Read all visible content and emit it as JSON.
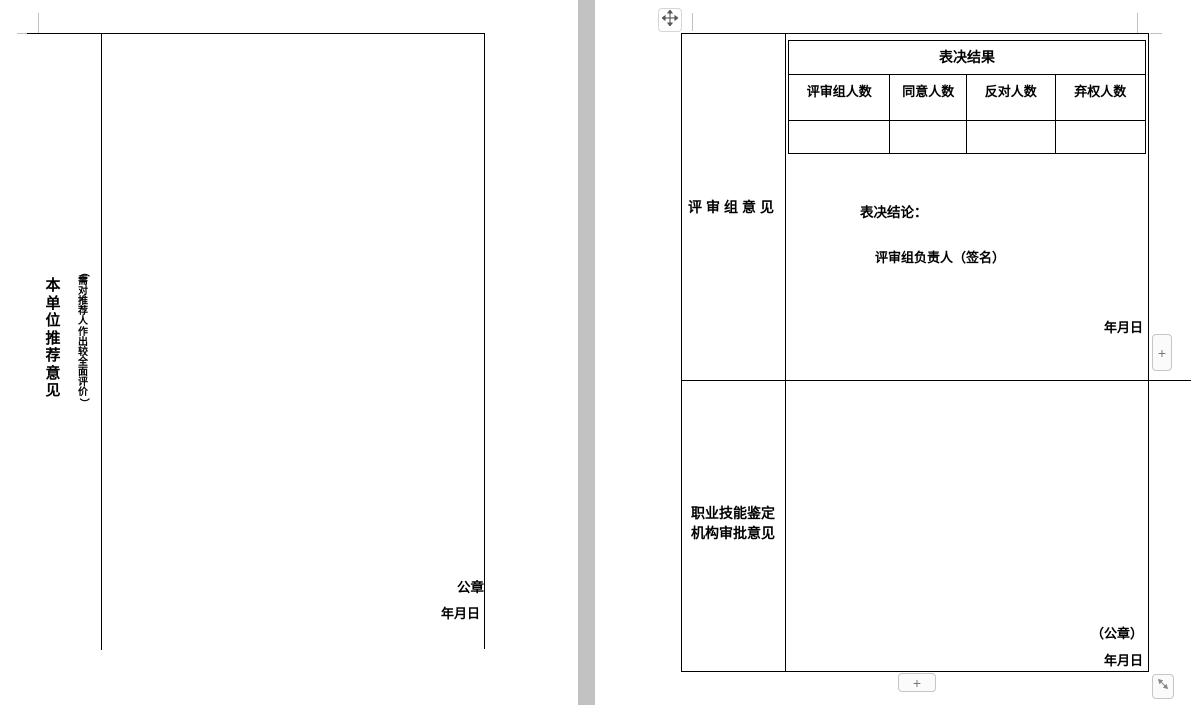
{
  "colors": {
    "page_bg": "#ffffff",
    "table_border": "#000000",
    "page_divider": "#c2c2c2",
    "margin_mark": "#c0c0c0",
    "control_border": "#c6c6c6",
    "control_bg": "#fbfbfb",
    "control_fg": "#777777"
  },
  "page_left": {
    "row_label": "本单位推荐意见",
    "row_label_note": "（需对推荐人作出较全面评价）",
    "seal_label": "公章",
    "date_label": "年月日"
  },
  "page_right": {
    "review_section": {
      "row_label": "评审组意见",
      "vote_table": {
        "title": "表决结果",
        "columns": [
          "评审组人数",
          "同意人数",
          "反对人数",
          "弃权人数"
        ],
        "values": [
          "",
          "",
          "",
          ""
        ]
      },
      "conclusion_label": "表决结论：",
      "signer_label": "评审组负责人（签名）",
      "date_label": "年月日"
    },
    "approval_section": {
      "row_label_line1": "职业技能鉴定",
      "row_label_line2": "机构审批意见",
      "seal_label": "（公章）",
      "date_label": "年月日"
    }
  },
  "controls": {
    "move_handle_icon": "move-cross-icon",
    "insert_right_label": "+",
    "insert_bottom_label": "+",
    "resize_icon": "resize-diagonal-icon"
  }
}
